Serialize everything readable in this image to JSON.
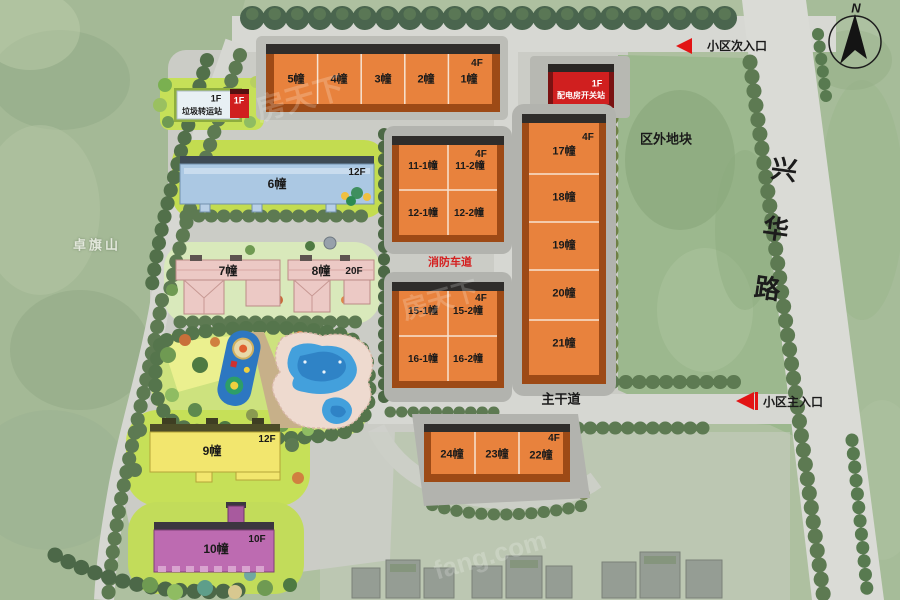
{
  "compass": {
    "north": "N"
  },
  "watermark": {
    "brand": "房天下",
    "site": "fang.com"
  },
  "labels": {
    "mountain": "卓旗山",
    "outside_plot": "区外地块",
    "road_vertical": "兴华路",
    "main_road": "主干道",
    "fire_lane": "消防车道",
    "entrance_secondary": "小区次入口",
    "entrance_main": "小区主入口"
  },
  "facilities": {
    "garbage": {
      "floor": "1F",
      "name": "垃圾转运站"
    },
    "garbage_annex": {
      "floor": "1F"
    },
    "power": {
      "floor": "1F",
      "name": "配电房开关站"
    }
  },
  "blocks": {
    "row1": {
      "floor": "4F",
      "b5": "5幢",
      "b4": "4幢",
      "b3": "3幢",
      "b2": "2幢",
      "b1": "1幢"
    },
    "b6": {
      "label": "6幢",
      "floor": "12F"
    },
    "b7": {
      "label": "7幢"
    },
    "b8": {
      "label": "8幢",
      "floor": "20F"
    },
    "b9": {
      "label": "9幢",
      "floor": "12F"
    },
    "b10": {
      "label": "10幢",
      "floor": "10F"
    },
    "mid_a": {
      "floor": "4F",
      "c1": "11-1幢",
      "c2": "11-2幢",
      "c3": "12-1幢",
      "c4": "12-2幢"
    },
    "mid_b": {
      "floor": "4F",
      "c1": "15-1幢",
      "c2": "15-2幢",
      "c3": "16-1幢",
      "c4": "16-2幢"
    },
    "col_right": {
      "floor": "4F",
      "b17": "17幢",
      "b18": "18幢",
      "b19": "19幢",
      "b20": "20幢",
      "b21": "21幢"
    },
    "row_bottom": {
      "floor": "4F",
      "b24": "24幢",
      "b23": "23幢",
      "b22": "22幢"
    }
  },
  "colors": {
    "building_orange": "#e8823d",
    "building_blue": "#abc8e3",
    "building_pink": "#ecc9c5",
    "building_yellow": "#f2e66e",
    "building_purple": "#bd6bb1",
    "station_red": "#d01f1f",
    "arrow_red": "#e21414",
    "road_gray": "#d7d8d3",
    "lawn_green": "#c6e058",
    "tree_green": "#5d7a52"
  }
}
